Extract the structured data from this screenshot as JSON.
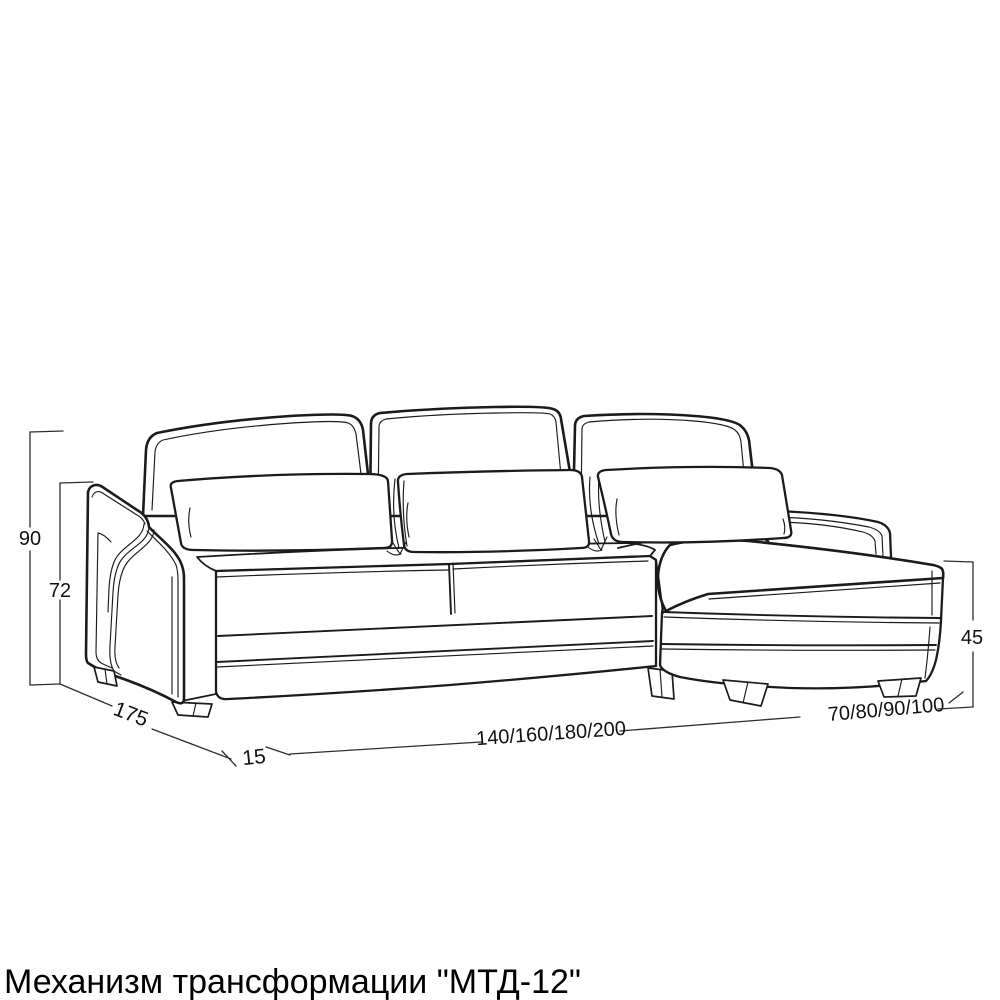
{
  "page": {
    "background_color": "#ffffff"
  },
  "caption": {
    "text": "Механизм трансформации \"МТД-12\""
  },
  "diagram": {
    "type": "technical-line-drawing",
    "subject": "corner sofa with chaise lounge, three-quarter view",
    "line_color": "#1b1b1b",
    "dimension_line_color": "#2e2e2e",
    "dimensions": {
      "total_height": "90",
      "back_height": "72",
      "depth": "175",
      "arm_offset": "15",
      "seat_width_options": "140/160/180/200",
      "chaise_width_options": "70/80/90/100",
      "chaise_height": "45"
    }
  }
}
